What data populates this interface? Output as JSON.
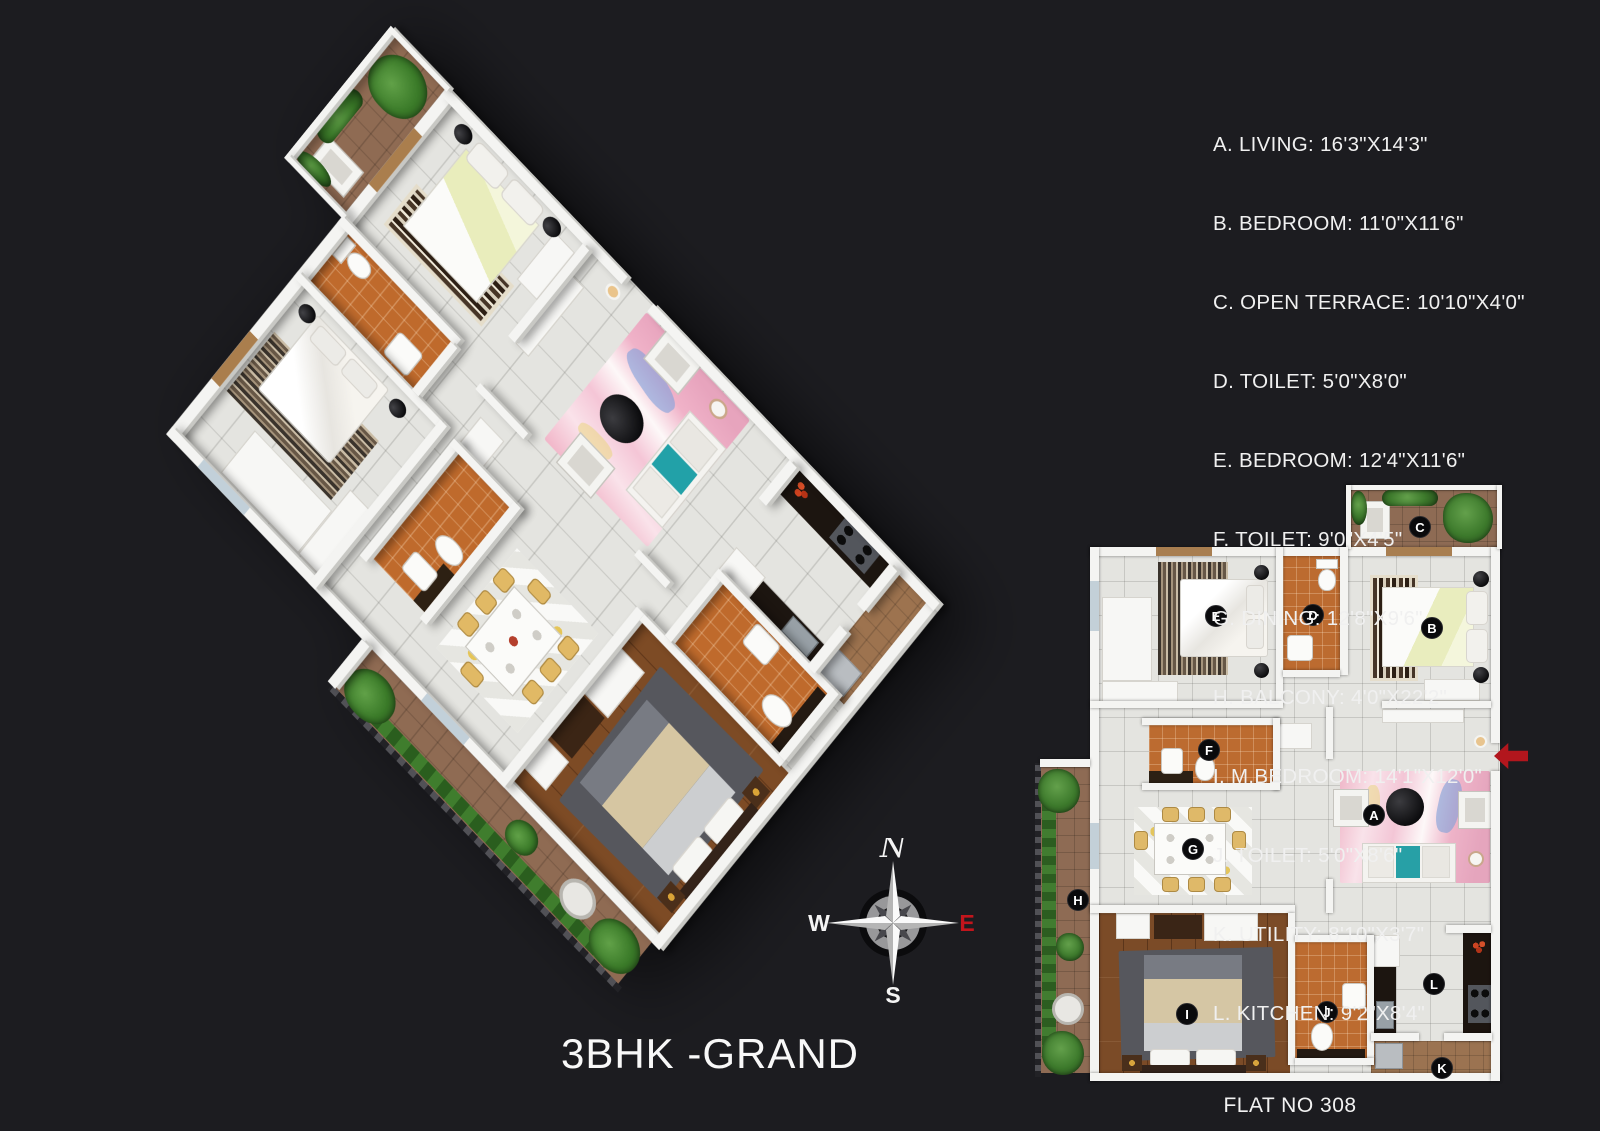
{
  "title": "3BHK -GRAND",
  "flat_label": "FLAT NO 308",
  "compass": {
    "north": "N",
    "east": "E",
    "south": "S",
    "west": "W",
    "east_color": "#c2151c"
  },
  "colors": {
    "background": "#1c1c20",
    "badge": "#0a0a0c",
    "entry_arrow": "#b2161d",
    "wall": "#f4f4f2"
  },
  "rooms": [
    {
      "letter": "A",
      "name": "LIVING",
      "dims": "16'3\"X14'3\"",
      "label": "A. LIVING: 16'3\"X14'3\""
    },
    {
      "letter": "B",
      "name": "BEDROOM",
      "dims": "11'0\"X11'6\"",
      "label": "B. BEDROOM: 11'0\"X11'6\""
    },
    {
      "letter": "C",
      "name": "OPEN TERRACE",
      "dims": "10'10\"X4'0\"",
      "label": "C. OPEN TERRACE: 10'10\"X4'0\""
    },
    {
      "letter": "D",
      "name": "TOILET",
      "dims": "5'0\"X8'0\"",
      "label": "D. TOILET: 5'0\"X8'0\""
    },
    {
      "letter": "E",
      "name": "BEDROOM",
      "dims": "12'4\"X11'6\"",
      "label": "E. BEDROOM: 12'4\"X11'6\""
    },
    {
      "letter": "F",
      "name": "TOILET",
      "dims": "9'0\"X4'5\"",
      "label": "F. TOILET: 9'0\"X4'5\""
    },
    {
      "letter": "G",
      "name": "DINING",
      "dims": "12'8\"X9'6\"",
      "label": "G. DINING: 12'8\"X9'6\""
    },
    {
      "letter": "H",
      "name": "BALCONY",
      "dims": "4'0\"X22'2\"",
      "label": "H. BALCONY: 4'0\"X22'2\""
    },
    {
      "letter": "I",
      "name": "M.BEDROOM",
      "dims": "14'1\"X12'0\"",
      "label": "I. M.BEDROOM: 14'1\"X12'0\""
    },
    {
      "letter": "J",
      "name": "TOILET",
      "dims": "5'0\"X8'6\"",
      "label": "J. TOILET: 5'0\"X8'6\""
    },
    {
      "letter": "K",
      "name": "UTILITY",
      "dims": "8'10\"X3'7\"",
      "label": "K. UTILITY: 8'10\"X3'7\""
    },
    {
      "letter": "L",
      "name": "KITCHEN",
      "dims": "9'2\"X8'4\"",
      "label": "L. KITCHEN: 9'2\"X8'4\""
    }
  ]
}
